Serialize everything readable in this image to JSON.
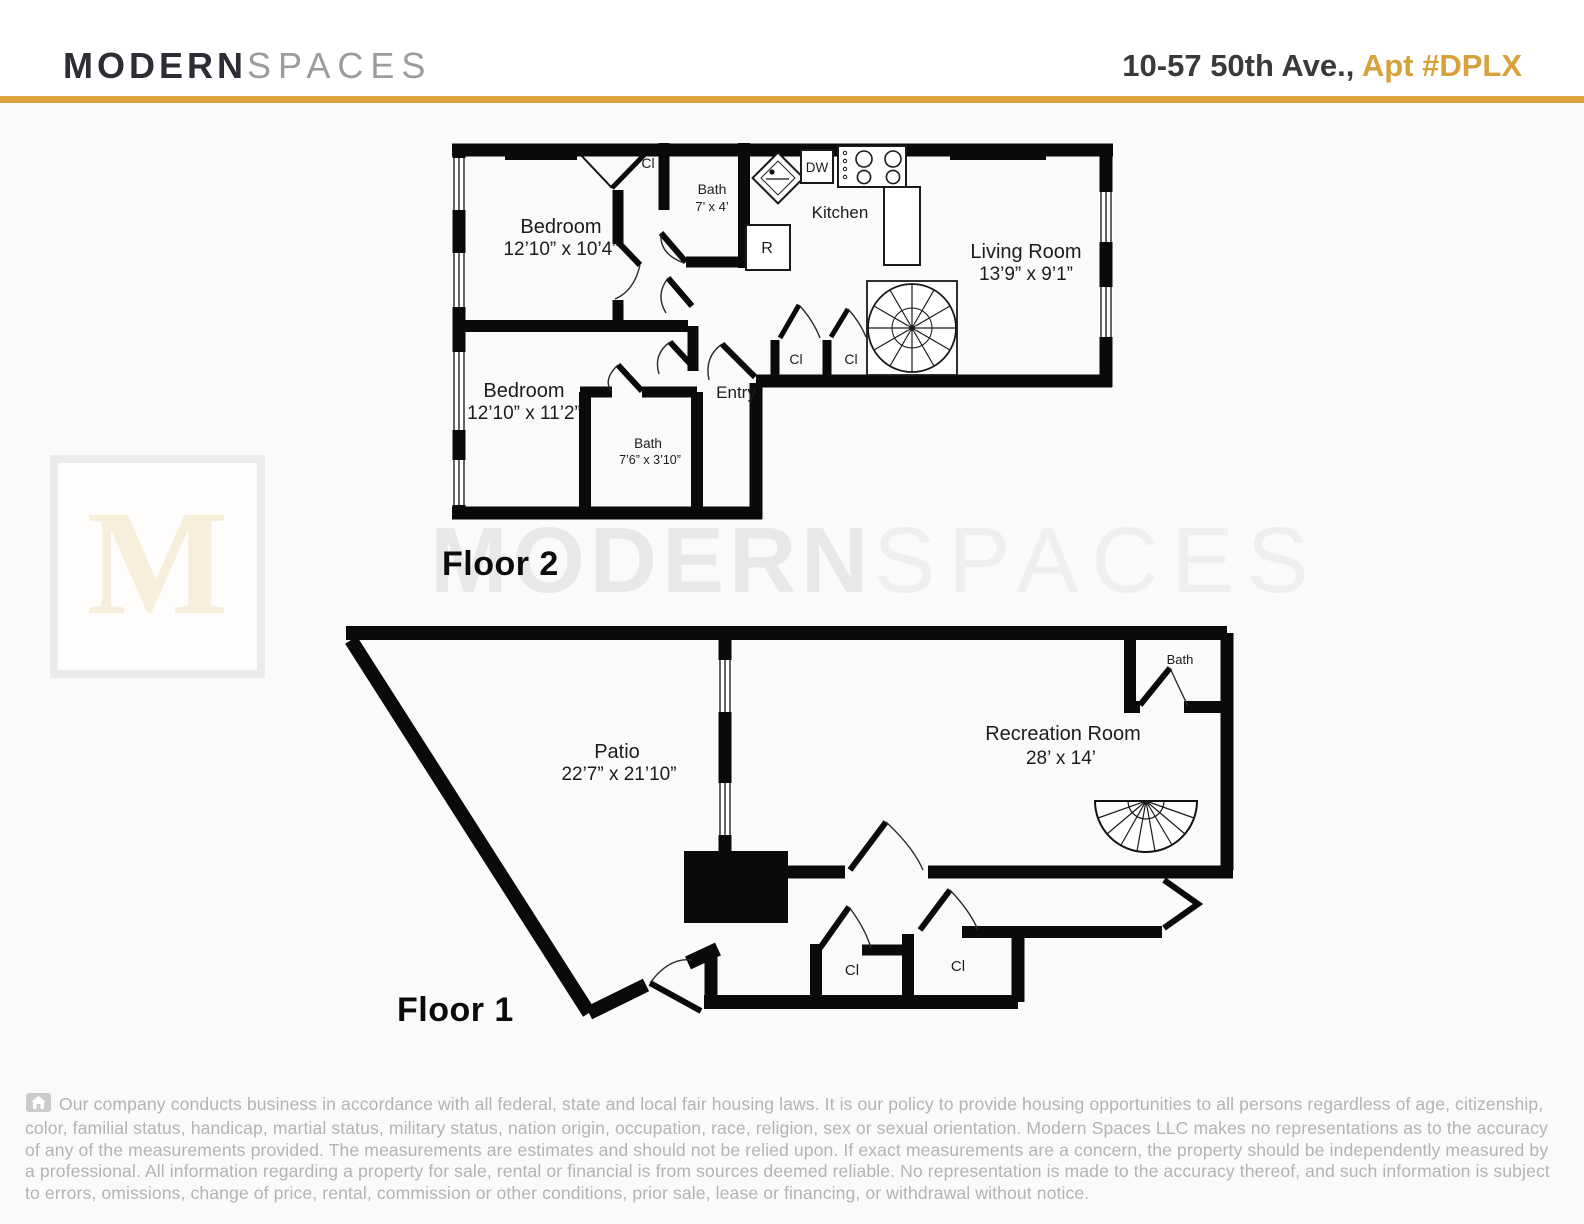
{
  "header": {
    "brand_bold": "MODERN",
    "brand_light": "SPACES",
    "address": "10-57 50th Ave., ",
    "unit": "Apt #DPLX"
  },
  "watermark": {
    "letter": "M",
    "bold": "MODERN",
    "light": "SPACES"
  },
  "floor2": {
    "label": "Floor 2",
    "bedroom1": {
      "name": "Bedroom",
      "dims": "12’10” x 10’4”"
    },
    "bedroom2": {
      "name": "Bedroom",
      "dims": "12’10” x 11’2”"
    },
    "bath1": {
      "name": "Bath",
      "dims": "7’ x 4’"
    },
    "bath2": {
      "name": "Bath",
      "dims": "7’6” x 3’10”"
    },
    "kitchen": "Kitchen",
    "living": {
      "name": "Living Room",
      "dims": "13’9” x 9’1”"
    },
    "entry": "Entry",
    "closet": "Cl",
    "dishwasher": "DW",
    "fridge": "R"
  },
  "floor1": {
    "label": "Floor 1",
    "patio": {
      "name": "Patio",
      "dims": "22’7” x 21’10”"
    },
    "rec": {
      "name": "Recreation Room",
      "dims": "28’ x 14’"
    },
    "bath": "Bath",
    "closet": "Cl"
  },
  "footer": {
    "disclaimer": "Our company conducts business in accordance with all federal, state and local fair housing laws. It is our policy to provide housing opportunities to all persons regardless of age, citizenship, color, familial status, handicap, martial status, military status, nation origin, occupation, race, religion, sex or sexual orientation. Modern Spaces LLC makes no representations as to the accuracy of any of the measurements provided. The measurements are estimates and should not be relied upon. If exact measurements are a concern, the property should be independently measured by a professional. All information regarding a property for sale, rental or financial is from  sources deemed reliable. No representation is made to the accuracy thereof, and such information is subject to errors, omissions, change of price, rental, commission or other conditions, prior sale, lease or financing, or withdrawal without notice."
  },
  "colors": {
    "accent_gold": "#DCA43E",
    "brand_dark": "#2D2D35",
    "brand_gray": "#9C9CA0",
    "disclaimer_gray": "#B3B3B3",
    "wall_black": "#0A0A0A"
  }
}
